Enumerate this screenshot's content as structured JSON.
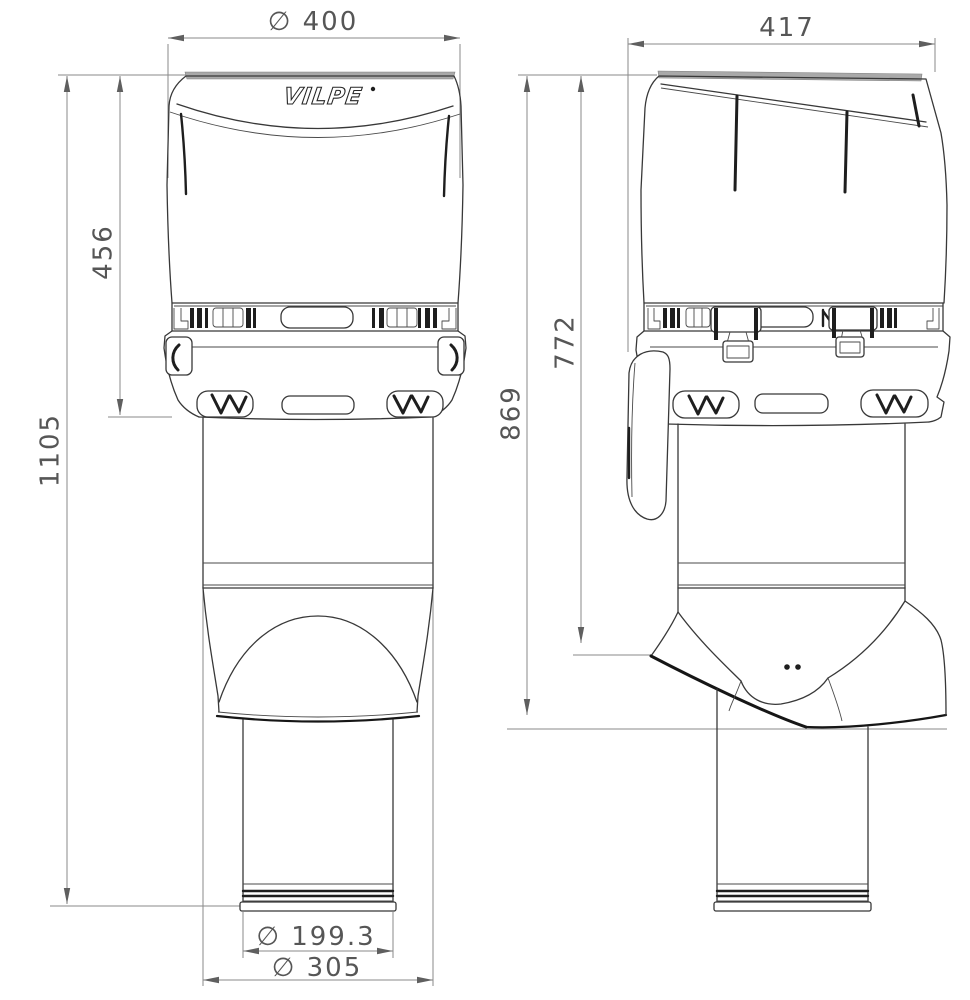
{
  "drawing": {
    "brand_logo": "VILPE",
    "colors": {
      "background": "#ffffff",
      "outline": "#383838",
      "heavy_edge": "#161616",
      "dimension_line": "#8a8a8a",
      "dimension_text": "#565656",
      "cap_top_band": "#a9a9a9"
    },
    "views": {
      "front": {
        "label": "front-view",
        "dims": {
          "cap_diameter": {
            "label": "∅ 400",
            "value": 400
          },
          "cap_height": {
            "label": "456",
            "value": 456
          },
          "total_height": {
            "label": "1105",
            "value": 1105
          },
          "pipe_diameter": {
            "label": "∅ 199.3",
            "value": 199.3
          },
          "base_diameter": {
            "label": "∅ 305",
            "value": 305
          }
        }
      },
      "side": {
        "label": "side-view",
        "dims": {
          "cap_width": {
            "label": "417",
            "value": 417
          },
          "overall_height": {
            "label": "869",
            "value": 869
          },
          "flashing_height": {
            "label": "772",
            "value": 772
          }
        }
      }
    }
  }
}
